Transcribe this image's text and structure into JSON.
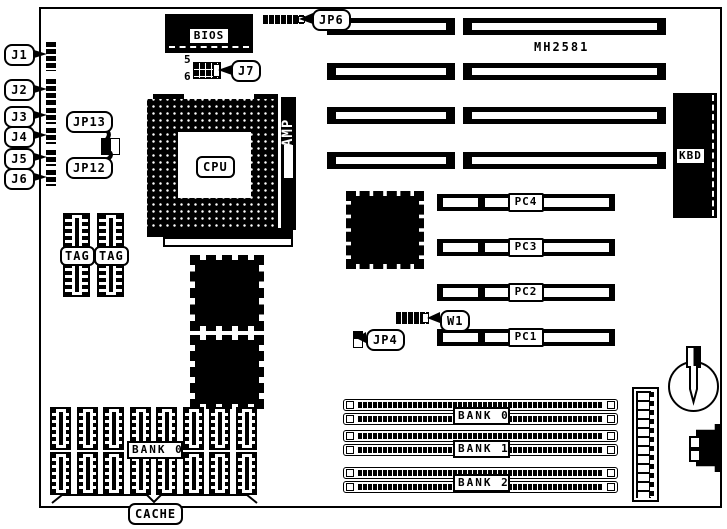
{
  "board": {
    "model": "MH2581"
  },
  "colors": {
    "ink": "#000000",
    "paper": "#ffffff"
  },
  "callouts": {
    "j1": "J1",
    "j2": "J2",
    "j3": "J3",
    "j4": "J4",
    "j5": "J5",
    "j6": "J6",
    "jp13": "JP13",
    "jp12": "JP12",
    "j7": "J7",
    "jp6": "JP6",
    "jp4": "JP4",
    "w1": "W1"
  },
  "j7_pins": {
    "top": "5",
    "bottom": "6"
  },
  "chips": {
    "bios": "BIOS",
    "cpu": "CPU",
    "socket_brand": "AMP",
    "keyboard": "KBD"
  },
  "slots": {
    "pci": [
      "PC4",
      "PC3",
      "PC2",
      "PC1"
    ]
  },
  "memory": {
    "simm_banks": [
      "BANK 0",
      "BANK 1",
      "BANK 2"
    ],
    "cache_bank": "BANK 0",
    "cache": "CACHE",
    "tags": [
      "TAG",
      "TAG"
    ]
  }
}
